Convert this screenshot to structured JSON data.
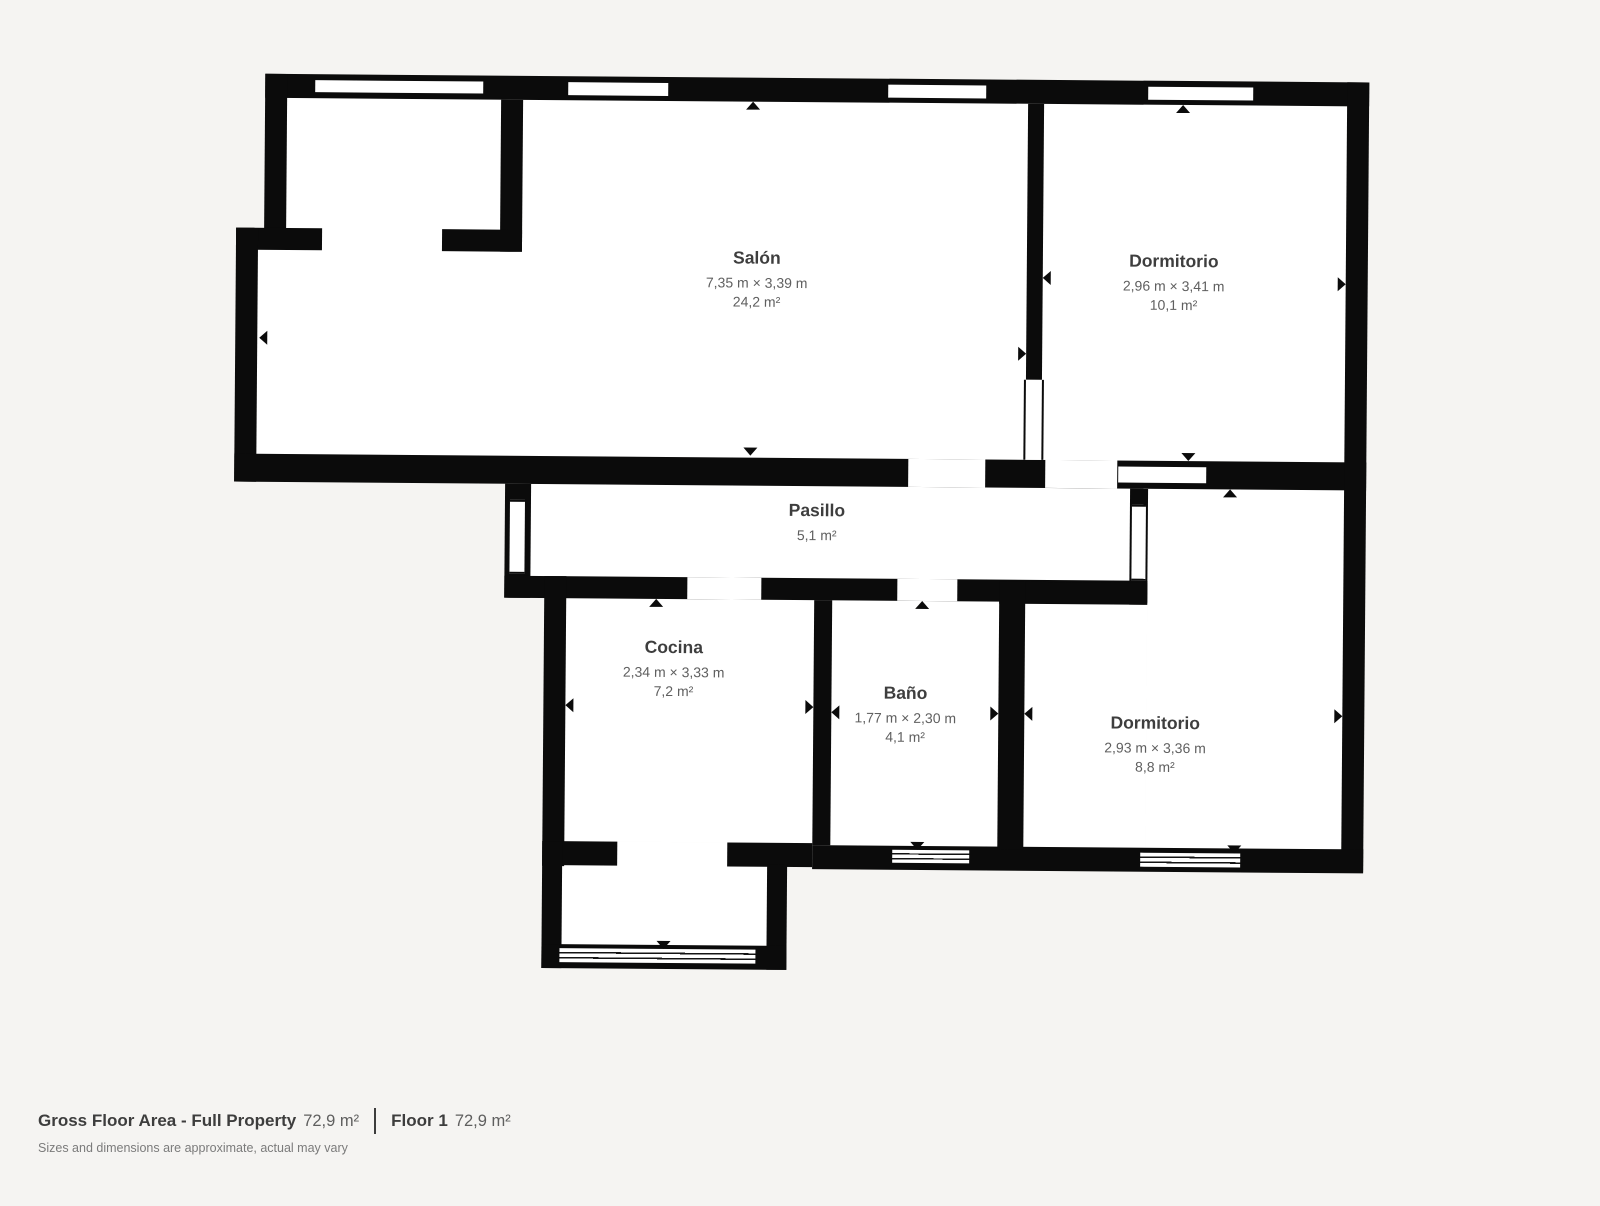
{
  "colors": {
    "background": "#f5f4f2",
    "wall": "#0b0b0b",
    "room_fill": "#ffffff",
    "room_name": "#3e3e3e",
    "room_dims": "#5f5f5f",
    "footer_text": "#3d3d3d",
    "footer_value": "#5f5f5f",
    "disclaimer": "#7b7b7b"
  },
  "rooms": {
    "salon": {
      "name": "Salón",
      "dims": "7,35 m × 3,39 m",
      "area": "24,2 m²"
    },
    "dormitorio1": {
      "name": "Dormitorio",
      "dims": "2,96 m × 3,41 m",
      "area": "10,1 m²"
    },
    "pasillo": {
      "name": "Pasillo",
      "area": "5,1 m²"
    },
    "cocina": {
      "name": "Cocina",
      "dims": "2,34 m × 3,33 m",
      "area": "7,2 m²"
    },
    "bano": {
      "name": "Baño",
      "dims": "1,77 m × 2,30 m",
      "area": "4,1 m²"
    },
    "dormitorio2": {
      "name": "Dormitorio",
      "dims": "2,93 m × 3,36 m",
      "area": "8,8 m²"
    }
  },
  "footer": {
    "gross_label": "Gross Floor Area - Full Property",
    "gross_value": "72,9 m²",
    "floor_label": "Floor 1",
    "floor_value": "72,9 m²",
    "disclaimer": "Sizes and dimensions are approximate, actual may vary"
  }
}
